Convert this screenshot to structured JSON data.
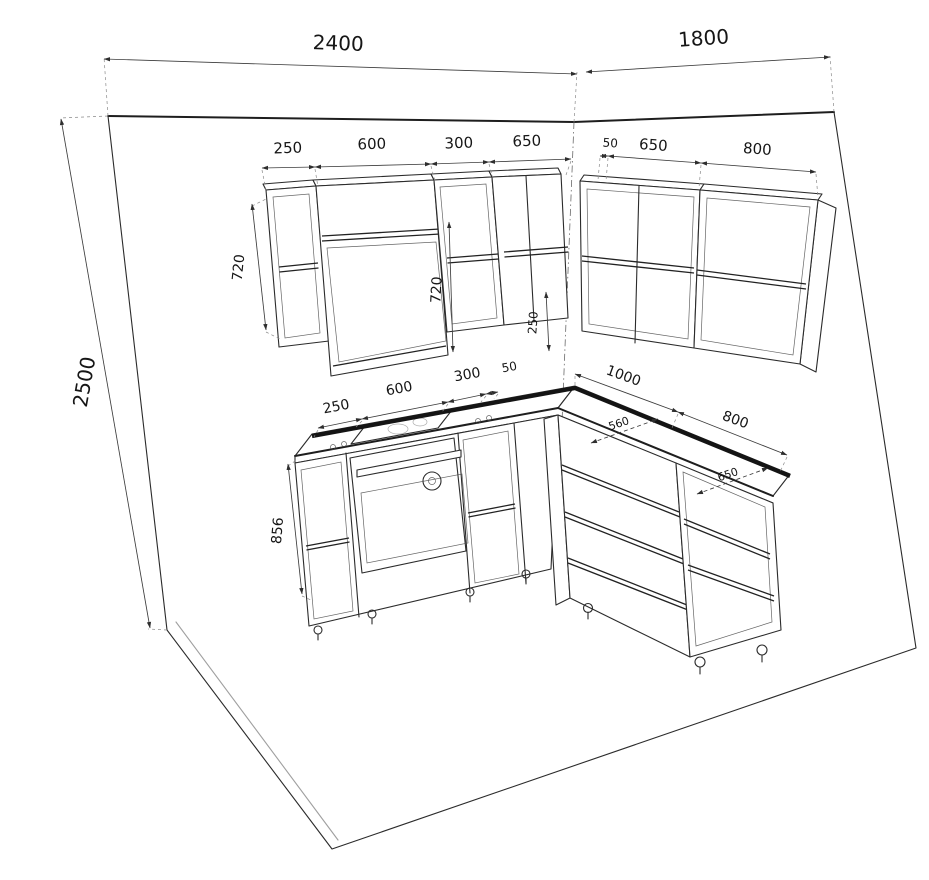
{
  "drawing": {
    "kind": "kitchen-corner-cabinet-isometric-drawing",
    "background_color": "#ffffff",
    "line_color": "#2b2b2b",
    "dimension_color": "#3c3c3c",
    "backsplash_color": "#141414"
  },
  "dimensions": {
    "left_wall_width": "2400",
    "right_wall_width": "1800",
    "wall_height": "2500",
    "upper_left_row": [
      "250",
      "600",
      "300",
      "650"
    ],
    "upper_right_row": [
      "50",
      "650",
      "800"
    ],
    "upper_height_left": "720",
    "upper_height_hood": "720",
    "corner_gap": "250",
    "base_left_row": [
      "250",
      "600",
      "300",
      "50"
    ],
    "base_right_row": [
      "1000",
      "800"
    ],
    "base_height": "856",
    "counter_depth_right_1": "560",
    "counter_depth_right_2": "650"
  }
}
